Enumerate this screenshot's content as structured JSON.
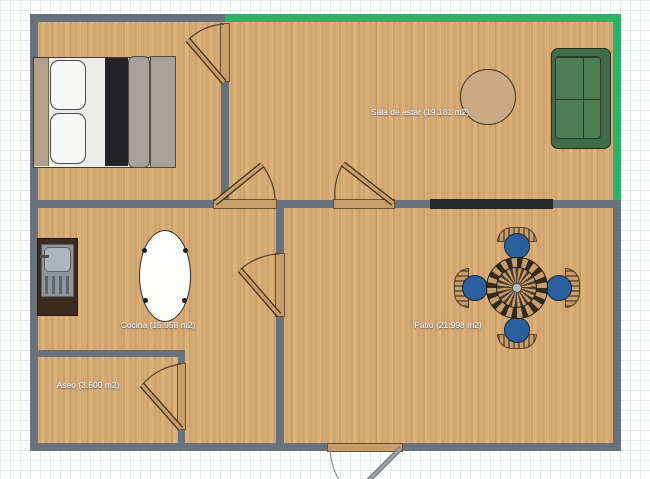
{
  "plan": {
    "rooms": [
      {
        "id": "sala-de-estar",
        "label": "Sala de estar (19.181 m2)"
      },
      {
        "id": "cocina",
        "label": "Cocina (15.958 m2)"
      },
      {
        "id": "patio",
        "label": "Patio (21.998 m2)"
      },
      {
        "id": "aseo",
        "label": "Aseo (3.600 m2)"
      }
    ],
    "colors": {
      "wall": "#67727d",
      "wall_highlight": "#2eb26a",
      "floor_wood": "#d2a772",
      "window": "#27292c",
      "door_wood": "#c79d6b",
      "sofa_green": "#4d7f53",
      "chair_blue": "#2c5f9e",
      "table_tan": "#c9ab85"
    },
    "furniture_icons": [
      "double-bed-icon",
      "sofa-icon",
      "round-table-icon",
      "oval-table-icon",
      "kitchen-sink-icon",
      "patio-table-icon",
      "patio-chair-icon"
    ],
    "opening_counts": {
      "doors": 6,
      "windows": 1
    }
  }
}
